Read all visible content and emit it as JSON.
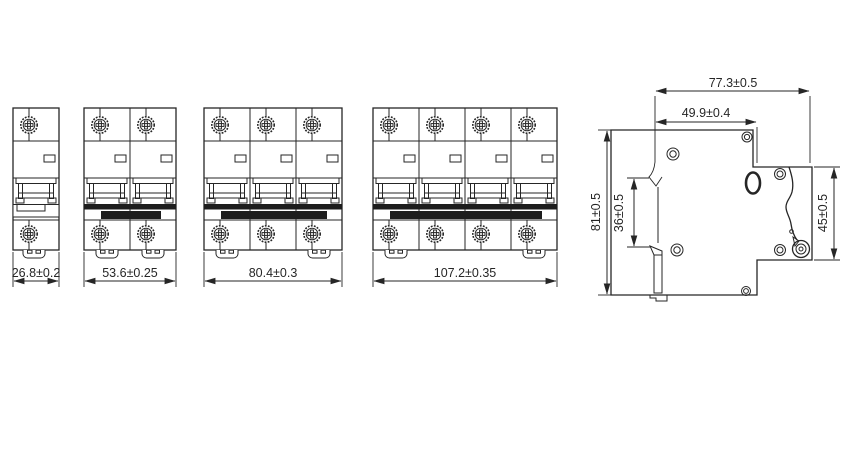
{
  "front_views": [
    {
      "name": "1-pole",
      "poles": 1,
      "width_label": "26.8±0.2"
    },
    {
      "name": "2-pole",
      "poles": 2,
      "width_label": "53.6±0.25"
    },
    {
      "name": "3-pole",
      "poles": 3,
      "width_label": "80.4±0.3"
    },
    {
      "name": "4-pole",
      "poles": 4,
      "width_label": "107.2±0.35"
    }
  ],
  "side_view": {
    "overall_depth_label": "77.3±0.5",
    "rail_seat_to_front_label": "49.9±0.4",
    "overall_height_label": "81±0.5",
    "rail_recess_height_label": "36±0.5",
    "front_section_height_label": "45±0.5"
  },
  "colors": {
    "line": "#262626",
    "fill_dark": "#1d1d1d",
    "background": "#ffffff"
  }
}
